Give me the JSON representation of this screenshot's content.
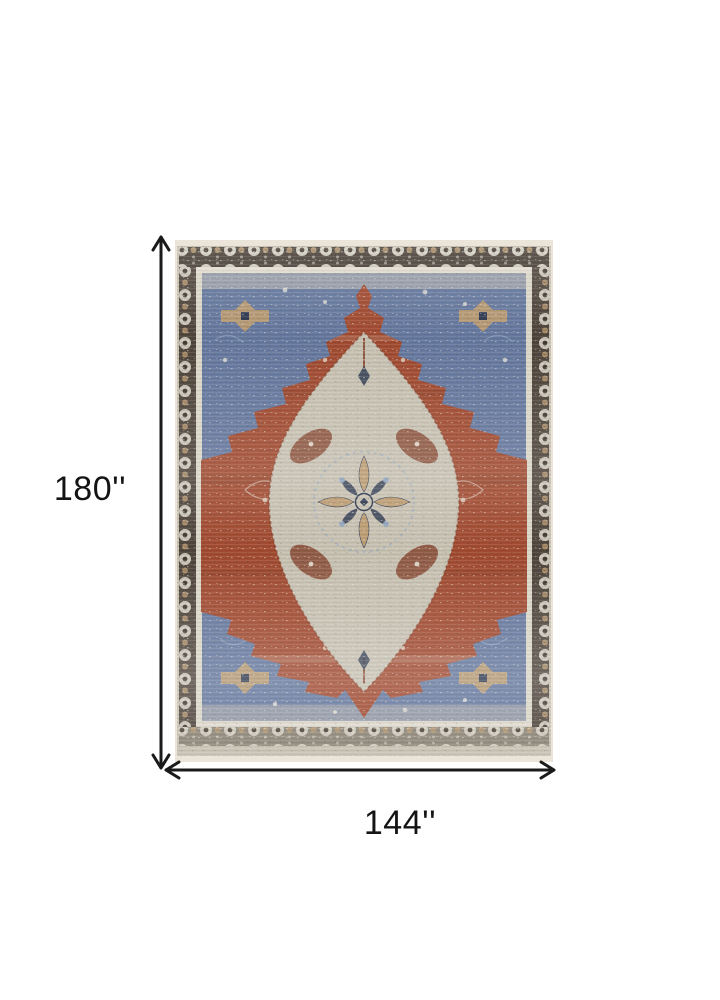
{
  "dimension_annotations": {
    "height_label": "180''",
    "width_label": "144''"
  },
  "rug_image": {
    "name": "distressed-oriental-medallion-rug"
  },
  "colors": {
    "page_bg": "#ffffff",
    "arrow": "#1a1a1a",
    "label_text": "#141414",
    "cream": "#eae5d8",
    "field_light": "#c6c0b1",
    "border_dark": "#433a31",
    "border_faded": "#8b8375",
    "blue": "#64779d",
    "blue_light": "#93a7c2",
    "rust": "#a04a30",
    "rust_dark": "#7e3a23",
    "tan": "#bb9a6e",
    "navy": "#2e3950"
  }
}
